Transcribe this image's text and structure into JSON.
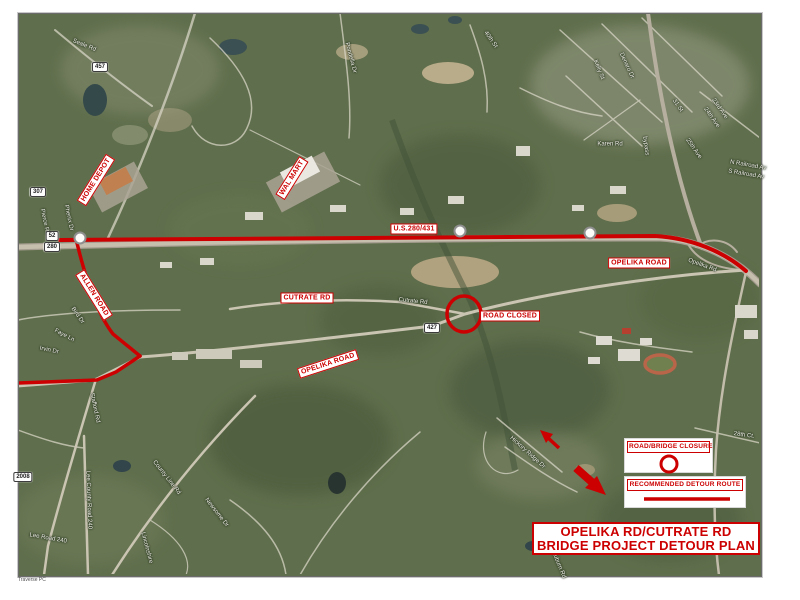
{
  "map": {
    "title": {
      "line1": "OPELIKA RD/CUTRATE RD",
      "line2": "BRIDGE PROJECT DETOUR PLAN"
    },
    "legend": {
      "closure_label": "ROAD/BRIDGE CLOSURE",
      "detour_label": "RECOMMENDED DETOUR ROUTE"
    },
    "credit": "Traverse PC",
    "colors": {
      "detour_red": "#cc0000",
      "label_background": "#ffffff",
      "satellite_green": "#5f6e4c"
    },
    "annotations": {
      "road_labels": [
        {
          "name": "home-depot-label",
          "text": "HOME DEPOT",
          "x": 96,
          "y": 180,
          "rot": -58
        },
        {
          "name": "wal-mart-label",
          "text": "WAL MART",
          "x": 292,
          "y": 178,
          "rot": -58
        },
        {
          "name": "us-280-431-label",
          "text": "U.S.280/431",
          "x": 414,
          "y": 229,
          "rot": 0
        },
        {
          "name": "opelika-road-label-east",
          "text": "OPELIKA ROAD",
          "x": 639,
          "y": 263,
          "rot": 0
        },
        {
          "name": "cutrate-rd-label",
          "text": "CUTRATE RD",
          "x": 307,
          "y": 298,
          "rot": 0
        },
        {
          "name": "road-closed-label",
          "text": "ROAD CLOSED",
          "x": 510,
          "y": 316,
          "rot": 0
        },
        {
          "name": "allen-road-label",
          "text": "ALLEN ROAD",
          "x": 94,
          "y": 295,
          "rot": 58
        },
        {
          "name": "opelika-road-label-south",
          "text": "OPELIKA ROAD",
          "x": 328,
          "y": 364,
          "rot": -18
        }
      ]
    },
    "base_map": {
      "route_shields": [
        {
          "text": "457",
          "x": 100,
          "y": 67
        },
        {
          "text": "307",
          "x": 38,
          "y": 192
        },
        {
          "text": "52",
          "x": 52,
          "y": 236
        },
        {
          "text": "280",
          "x": 52,
          "y": 247
        },
        {
          "text": "427",
          "x": 432,
          "y": 328
        },
        {
          "text": "2008",
          "x": 23,
          "y": 477
        }
      ],
      "us_route_shields": [
        {
          "x": 80,
          "y": 238
        },
        {
          "x": 460,
          "y": 231
        },
        {
          "x": 590,
          "y": 233
        }
      ],
      "street_labels": [
        {
          "text": "Seale Rd",
          "x": 84,
          "y": 46,
          "rot": 22
        },
        {
          "text": "Pondella Dr",
          "x": 350,
          "y": 58,
          "rot": 75
        },
        {
          "text": "40th St",
          "x": 490,
          "y": 40,
          "rot": 55
        },
        {
          "text": "Kelly St",
          "x": 598,
          "y": 70,
          "rot": 68
        },
        {
          "text": "Denaro Dr",
          "x": 626,
          "y": 66,
          "rot": 65
        },
        {
          "text": "31 St",
          "x": 677,
          "y": 106,
          "rot": 55
        },
        {
          "text": "23rd Ave",
          "x": 719,
          "y": 109,
          "rot": 55
        },
        {
          "text": "24th Ave",
          "x": 711,
          "y": 118,
          "rot": 55
        },
        {
          "text": "25th Ave",
          "x": 693,
          "y": 149,
          "rot": 55
        },
        {
          "text": "bypass",
          "x": 645,
          "y": 146,
          "rot": 82
        },
        {
          "text": "N Railroad Av",
          "x": 748,
          "y": 166,
          "rot": 10
        },
        {
          "text": "S Railroad Av",
          "x": 746,
          "y": 175,
          "rot": 10
        },
        {
          "text": "Karen Rd",
          "x": 610,
          "y": 145,
          "rot": 0
        },
        {
          "text": "Phenix Dr",
          "x": 68,
          "y": 218,
          "rot": 78
        },
        {
          "text": "Pierce Rd",
          "x": 44,
          "y": 222,
          "rot": 78
        },
        {
          "text": "Opelika Rd",
          "x": 702,
          "y": 266,
          "rot": 20
        },
        {
          "text": "Cutrate Rd",
          "x": 413,
          "y": 302,
          "rot": 6
        },
        {
          "text": "Bird Dr",
          "x": 77,
          "y": 316,
          "rot": 55
        },
        {
          "text": "Faye Ln",
          "x": 64,
          "y": 336,
          "rot": 28
        },
        {
          "text": "Irvin Dr",
          "x": 49,
          "y": 351,
          "rot": 12
        },
        {
          "text": "Stafford Rd",
          "x": 94,
          "y": 408,
          "rot": 78
        },
        {
          "text": "Lee County Road 240",
          "x": 88,
          "y": 500,
          "rot": 88
        },
        {
          "text": "County Line Rd",
          "x": 166,
          "y": 478,
          "rot": 52
        },
        {
          "text": "Lee Road 240",
          "x": 48,
          "y": 539,
          "rot": 10
        },
        {
          "text": "Newsome Dr",
          "x": 216,
          "y": 513,
          "rot": 52
        },
        {
          "text": "Lincolnshire",
          "x": 146,
          "y": 548,
          "rot": 75
        },
        {
          "text": "Hickory Ridge Dr",
          "x": 527,
          "y": 453,
          "rot": 42
        },
        {
          "text": "28th Ct.",
          "x": 744,
          "y": 436,
          "rot": 8
        },
        {
          "text": "Auburn Rd",
          "x": 558,
          "y": 565,
          "rot": 68
        }
      ]
    }
  }
}
